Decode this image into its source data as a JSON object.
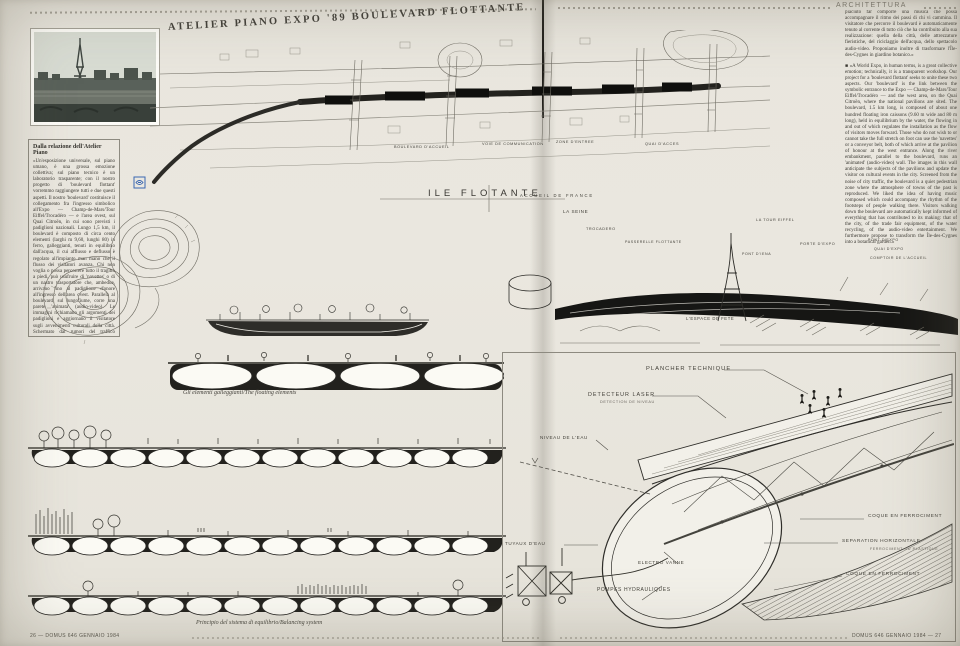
{
  "colors": {
    "paper": "#e9e6de",
    "ink": "#2e2d29",
    "stamp_blue": "#3a67b2",
    "river_dark": "#161614"
  },
  "magazine": {
    "section_header": "ARCHITETTURA",
    "title": "ATELIER PIANO EXPO '89 BOULEVARD FLOTTANTE",
    "footer_left": "26 — DOMUS 646 GENNAIO 1984",
    "footer_right": "DOMUS 646 GENNAIO 1984 — 27"
  },
  "left_column": {
    "heading": "Dalla relazione dell'Atelier Piano",
    "body": "«Un'esposizione universale, sul piano umano, è una grossa emozione collettiva; sul piano tecnico è un laboratorio trasparente; con il nostro progetto di 'boulevard flottant' vorremmo raggiungere tutti e due questi aspetti. Il nostro 'boulevard' costituisce il collegamento fra l'ingresso simbolico all'Expo — Champ-de-Mars/Tour Eiffel/Trocadéro — e l'area ovest, sul Quai Citroën, in cui sono previsti i padiglioni nazionali. Lungo 1,5 km, il boulevard è composto di circa cento elementi (larghi m 9,60, lunghi 80) in ferro, galleggianti, tenuti in equilibrio dall'acqua, il cui afflusso e deflusso è regolato all'impianto man mano che il flusso dei visitatori avanza. Chi non voglia o possa percorrere tutto il tragitto a piedi, può usufruire di 'navettes' o di un nastro trasportatore che, ambedue, arrivano fino al padiglione d'onore all'ingresso dell'area ovest. Parallela al boulevard, sul lungofiume, corre una parete 'animata' (audio-video). Le immagini richiamano gli argomenti dei padiglioni e aggiornano il visitatore sugli avvenimenti culturali della città. Schermato dai rumori del traffico metropolitano, il boulevard è una zona pedonale silenziosa in cui si riproduce l'atmosfera delle città di un tempo. Ci è"
  },
  "right_column": {
    "body_it": "piaciuto far comporre una musica che possa accompagnare il ritmo dei passi di chi vi cammina. Il visitatore che percorre il boulevard è automaticamente tenuto al corrente di tutto ciò che ha contribuito alla sua realizzazione: quella della città, delle attrezzature fieristiche, del riciclaggio dell'acqua, dello spettacolo audio-video. Proponiamo inoltre di trasformare l'Île-des-Cygnes in giardino botanico.»",
    "body_en": "■ «A World Expo, in human terms, is a great collective emotion; technically, it is a transparent workshop. Our project for a 'boulevard flottant' seeks to unite these two aspects. Our 'boulevard' is the link between the symbolic entrance to the Expo — Champ-de-Mars/Tour Eiffel/Trocadéro — and the west area, on the Quai Citroën, where the national pavilions are sited. The boulevard, 1.5 km long, is composed of about one hundred floating iron caissons (9.60 m wide and 80 m long), held in equilibrium by the water, the flowing in and out of which regulates the installation as the flow of visitors moves forward. Those who do not wish to or cannot take the full stretch on foot can use the 'navettes' or a conveyor belt, both of which arrive at the pavilion of honour at the west entrance. Along the river embankment, parallel to the boulevard, runs an 'animated' (audio-video) wall. The images in this wall anticipate the subjects of the pavilions and update the visitor on cultural events in the city. Screened from the noise of city traffic, the boulevard is a quiet pedestrian zone where the atmosphere of towns of the past is reproduced. We liked the idea of having music composed which could accompany the rhythm of the footsteps of people walking there. Visitors walking down the boulevard are automatically kept informed of everything that has contributed to its making: that of the city, of the trade fair equipment, of the water recycling, of the audio-video entertainment. We furthermore propose to transform the Île-des-Cygnes into a botanical garden.»"
  },
  "plan": {
    "labels": [
      {
        "text": "BOULEVARD D'ACCUEIL"
      },
      {
        "text": "VOIE DE COMMUNICATION"
      },
      {
        "text": "ZONE D'ENTREE"
      },
      {
        "text": "QUAI D'ACCES"
      },
      {
        "text": "ILE FLOTANTE"
      },
      {
        "text": "ACCUEIL DE FRANCE"
      }
    ]
  },
  "perspective": {
    "labels": [
      {
        "text": "LA SEINE"
      },
      {
        "text": "TROCADERO"
      },
      {
        "text": "PASSERELLE FLOTTANTE"
      },
      {
        "text": "LA TOUR EIFFEL"
      },
      {
        "text": "PORTE D'EXPO"
      },
      {
        "text": "PONT D'IENA"
      },
      {
        "text": "L'ESPACE DE FETE"
      },
      {
        "text": "PONT D'EXPO"
      },
      {
        "text": "QUAI D'EXPO"
      },
      {
        "text": "COMPTOIR DE L'ACCUEIL"
      }
    ]
  },
  "axon": {
    "labels": [
      {
        "text": "PLANCHER TECHNIQUE"
      },
      {
        "text": "DETECTEUR LASER"
      },
      {
        "text": "DETECTION DE NIVEAU"
      },
      {
        "text": "NIVEAU DE L'EAU"
      },
      {
        "text": "TUYAUX D'EAU"
      },
      {
        "text": "POMPES HYDRAULIQUES"
      },
      {
        "text": "ELECTRO VANNE"
      },
      {
        "text": "COQUE EN FERROCIMENT"
      },
      {
        "text": "SEPARATION HORIZONTALE"
      },
      {
        "text": "FERROCIMENT OU PLASTIQUE"
      },
      {
        "text": "COQUE EN FERROCIMENT"
      }
    ]
  },
  "captions": {
    "floating_elements": "Gli elementi galleggianti/The floating elements",
    "balancing": "Principio del sistema di equilibrio/Balancing system"
  }
}
